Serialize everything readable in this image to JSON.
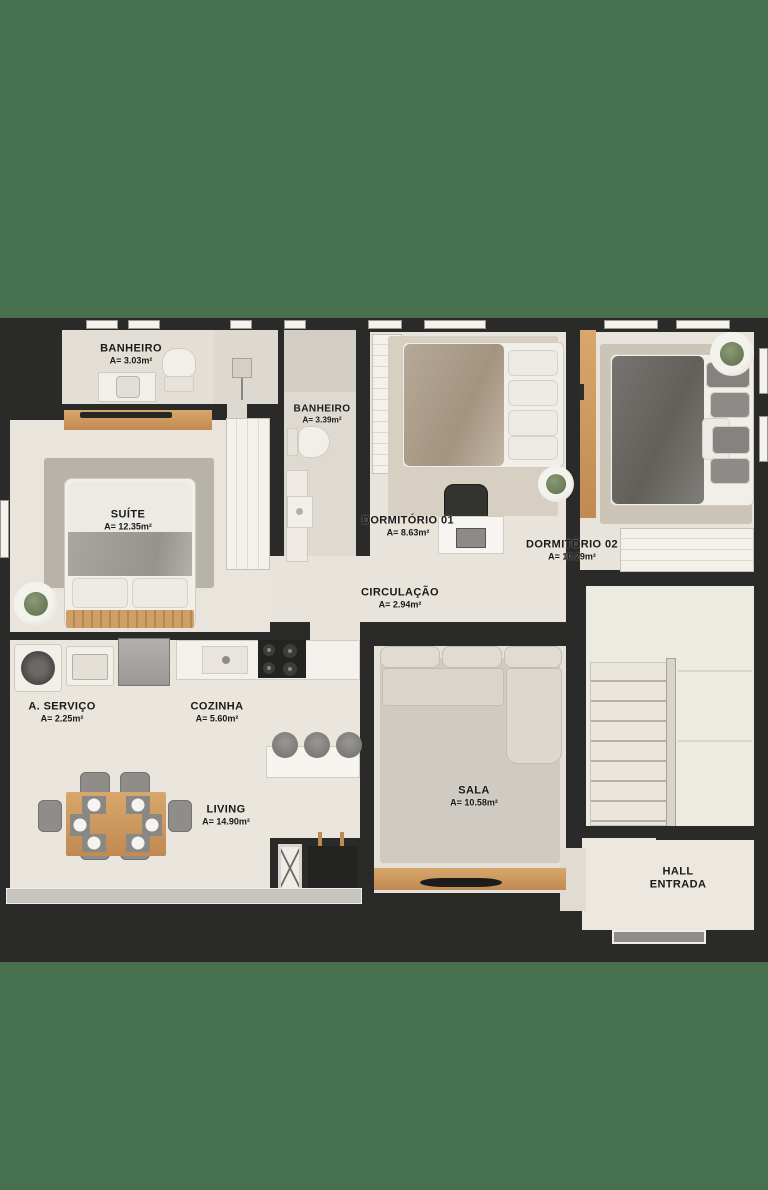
{
  "image_type": "apartment floor plan top-down render",
  "palette": {
    "background_green": "#47714e",
    "wall_dark": "#2a2a28",
    "floor_light": "#e8e3db",
    "wood_accent": "#c99a62",
    "rug_gray": "#b7b3ab",
    "label_text": "#191917"
  },
  "rooms": {
    "banheiro1": {
      "name": "BANHEIRO",
      "area": "A= 3.03m²"
    },
    "banheiro2": {
      "name": "BANHEIRO",
      "area": "A= 3.39m²"
    },
    "suite": {
      "name": "SUÍTE",
      "area": "A= 12.35m²"
    },
    "dormitorio1": {
      "name": "DORMITÓRIO 01",
      "area": "A= 8.63m²"
    },
    "dormitorio2": {
      "name": "DORMITÓRIO 02",
      "area": "A= 10.29m²"
    },
    "circulacao": {
      "name": "CIRCULAÇÃO",
      "area": "A= 2.94m²"
    },
    "aservico": {
      "name": "A. SERVIÇO",
      "area": "A= 2.25m²"
    },
    "cozinha": {
      "name": "COZINHA",
      "area": "A= 5.60m²"
    },
    "living": {
      "name": "LIVING",
      "area": "A= 14.90m²"
    },
    "sala": {
      "name": "SALA",
      "area": "A= 10.58m²"
    },
    "hall": {
      "line1": "HALL",
      "line2": "ENTRADA"
    }
  }
}
